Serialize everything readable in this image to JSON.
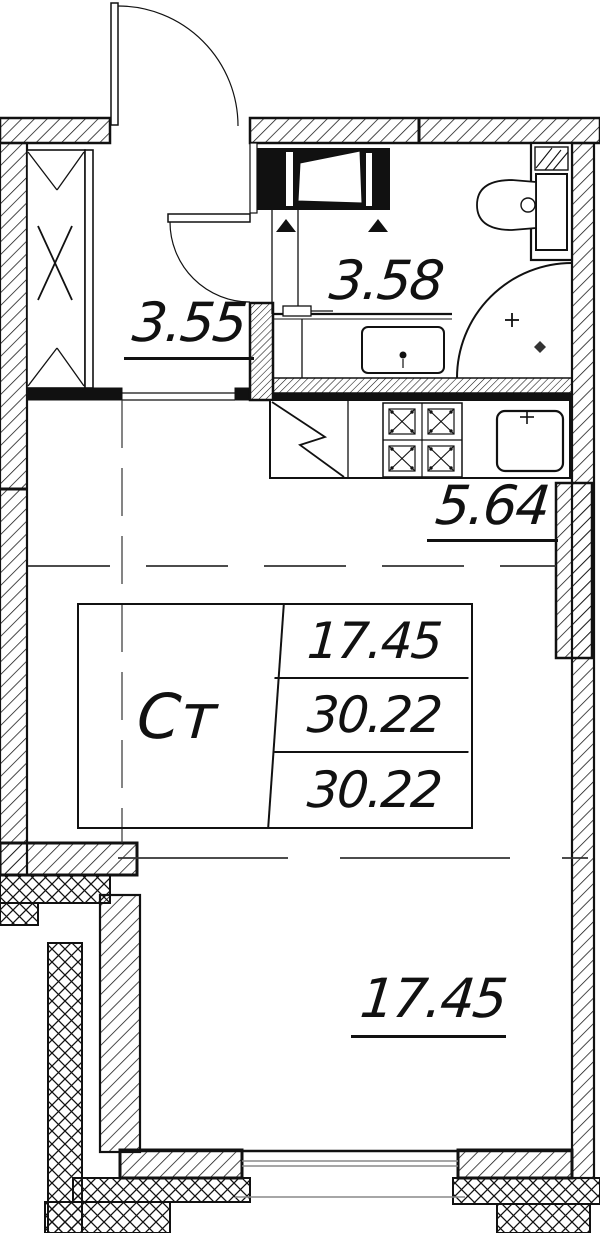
{
  "stamp": {
    "type_label": "Ст",
    "rows": [
      "17.45",
      "30.22",
      "30.22"
    ]
  },
  "rooms": {
    "hallway": {
      "area": "3.55"
    },
    "bathroom": {
      "area": "3.58"
    },
    "kitchen": {
      "area": "5.64"
    },
    "living": {
      "area": "17.45"
    }
  },
  "colors": {
    "line": "#111111",
    "glazing": "#888888",
    "bg": "#ffffff"
  }
}
